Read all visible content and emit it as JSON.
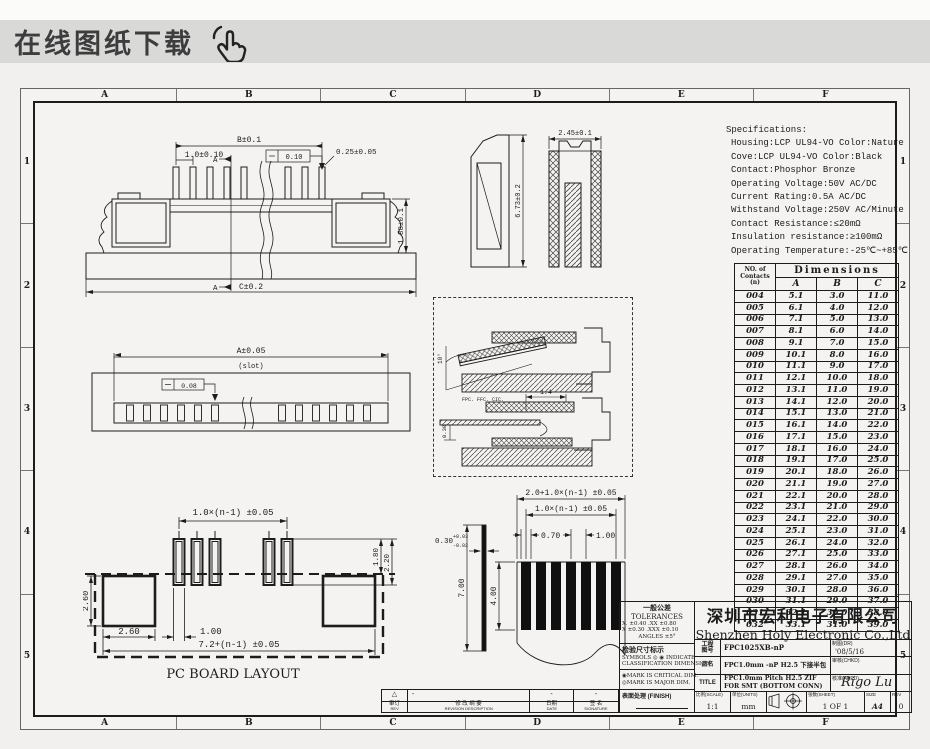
{
  "banner": {
    "title": "在线图纸下载",
    "icon": "hand-pointer-icon"
  },
  "colors": {
    "banner_bg": "#d9d9d8",
    "paper": "#f4f3f1",
    "line": "#1c1c1c"
  },
  "sheet": {
    "zones_h": [
      "A",
      "B",
      "C",
      "D",
      "E",
      "F"
    ],
    "zones_v": [
      "1",
      "2",
      "3",
      "4",
      "5"
    ]
  },
  "specifications": {
    "title": "Specifications:",
    "lines": [
      "Housing:LCP UL94-VO Color:Nature",
      "Cove:LCP UL94-VO Color:Black",
      "Contact:Phosphor Bronze",
      "Operating Voltage:50V AC/DC",
      "Current Rating:0.5A AC/DC",
      "Withstand Voltage:250V AC/Minute",
      "Contact Resistance:≤20mΩ",
      "Insulation resistance:≥100mΩ",
      "Operating Temperature:-25℃~+85℃"
    ]
  },
  "dim_table": {
    "row_header_1": "NO. of",
    "row_header_2": "Contacts",
    "row_header_3": "(n)",
    "col_group": "Dimensions",
    "columns": [
      "A",
      "B",
      "C"
    ],
    "rows": [
      [
        "004",
        "5.1",
        "3.0",
        "11.0"
      ],
      [
        "005",
        "6.1",
        "4.0",
        "12.0"
      ],
      [
        "006",
        "7.1",
        "5.0",
        "13.0"
      ],
      [
        "007",
        "8.1",
        "6.0",
        "14.0"
      ],
      [
        "008",
        "9.1",
        "7.0",
        "15.0"
      ],
      [
        "009",
        "10.1",
        "8.0",
        "16.0"
      ],
      [
        "010",
        "11.1",
        "9.0",
        "17.0"
      ],
      [
        "011",
        "12.1",
        "10.0",
        "18.0"
      ],
      [
        "012",
        "13.1",
        "11.0",
        "19.0"
      ],
      [
        "013",
        "14.1",
        "12.0",
        "20.0"
      ],
      [
        "014",
        "15.1",
        "13.0",
        "21.0"
      ],
      [
        "015",
        "16.1",
        "14.0",
        "22.0"
      ],
      [
        "016",
        "17.1",
        "15.0",
        "23.0"
      ],
      [
        "017",
        "18.1",
        "16.0",
        "24.0"
      ],
      [
        "018",
        "19.1",
        "17.0",
        "25.0"
      ],
      [
        "019",
        "20.1",
        "18.0",
        "26.0"
      ],
      [
        "020",
        "21.1",
        "19.0",
        "27.0"
      ],
      [
        "021",
        "22.1",
        "20.0",
        "28.0"
      ],
      [
        "022",
        "23.1",
        "21.0",
        "29.0"
      ],
      [
        "023",
        "24.1",
        "22.0",
        "30.0"
      ],
      [
        "024",
        "25.1",
        "23.0",
        "31.0"
      ],
      [
        "025",
        "26.1",
        "24.0",
        "32.0"
      ],
      [
        "026",
        "27.1",
        "25.0",
        "33.0"
      ],
      [
        "027",
        "28.1",
        "26.0",
        "34.0"
      ],
      [
        "028",
        "29.1",
        "27.0",
        "35.0"
      ],
      [
        "029",
        "30.1",
        "28.0",
        "36.0"
      ],
      [
        "030",
        "31.1",
        "29.0",
        "37.0"
      ],
      [
        "031",
        "32.1",
        "30.0",
        "38.0"
      ],
      [
        "032",
        "33.1",
        "31.0",
        "39.0"
      ]
    ]
  },
  "views": {
    "front": {
      "dim_b": "B±0.1",
      "pitch": "1.0±0.10",
      "pin_width": "0.25±0.05",
      "flatness": "0.10",
      "height": "1.88±0.1",
      "dim_c": "C±0.2",
      "section_label": "A"
    },
    "side": {
      "height": "6.73±0.2",
      "width": "2.45±0.1"
    },
    "bottom": {
      "dim_a": "A±0.05",
      "slot_note": "(slot)",
      "flatness": "0.08"
    },
    "detail": {
      "angle": "10°",
      "dim_width": "1.4",
      "dim_thick": "0.30",
      "cable_note": "FPC. FFC. CIC."
    },
    "pcb": {
      "pitch": "1.0×(n-1) ±0.05",
      "pad_h1": "1.80",
      "pad_h2": "2.20",
      "height": "2.60",
      "pad_w": "2.60",
      "pad_gap": "1.00",
      "total": "7.2+(n-1) ±0.05",
      "caption": "PC BOARD LAYOUT"
    },
    "fpc": {
      "total": "2.0+1.0×(n-1) ±0.05",
      "pitch": "1.0×(n-1) ±0.05",
      "cond_w": "0.70",
      "cond_pitch": "1.00",
      "thick": "0.30",
      "thick_plus": "+0.03",
      "thick_minus": "-0.02",
      "length": "7.00",
      "exposed": "4.00"
    }
  },
  "title_block": {
    "company_cn": "深圳市宏利电子有限公司",
    "company_en": "Shenzhen Holy Electronic Co.,Ltd",
    "eng_label_1": "工程",
    "eng_label_2": "图号",
    "eng_no": "FPC1025XB-nP",
    "part_label": "品名",
    "part": "FPC1.0mm -nP H2.5 下接半包",
    "title_label": "TITLE",
    "title_line1": "FPC1.0mm Pitch H2.5 ZIF",
    "title_line2": "FOR SMT (BOTTOM CONN)",
    "dr_label": "制图(DR)",
    "dr_value": "'08/5/16",
    "chkd_label": "审核(CHKD)",
    "chkd_value": "",
    "appd_label": "核准(APPD)",
    "appd_value": "Rigo Lu",
    "scale_label": "比例(SCALE)",
    "scale_value": "1:1",
    "units_label": "单位(UNITS)",
    "units_value": "mm",
    "sheet_label": "张数(SHEET)",
    "sheet_value": "1 OF 1",
    "size_label": "SIZE",
    "size_value": "A4",
    "rev_label": "REV",
    "rev_value": "0",
    "tolerances": {
      "title_cn": "一般公差",
      "title_en": "TOLERANCES",
      "line1": "X. ±0.40   .XX ±0.80",
      "line2": "X  ±0.30  .XXX ±0.10",
      "line3": "ANGLES    ±5°",
      "insp_title": "检验尺寸标示",
      "symbols_line1": "SYMBOLS ◎ ◉ INDICATE",
      "symbols_line2": "CLASSIFICATION DIMENSION",
      "critical": "◉MARK IS CRITICAL DIM.",
      "major": "◎MARK IS MAJOR DIM.",
      "finish_label": "表面处理 (FINISH)"
    }
  },
  "revision": {
    "mark": "△",
    "val2": "-",
    "val3": "-",
    "val4": "-",
    "cols": [
      {
        "cn": "审订",
        "en": "REV"
      },
      {
        "cn": "修 改 纲 要",
        "en": "REVISION DESCRIPTION"
      },
      {
        "cn": "日期",
        "en": "DATE"
      },
      {
        "cn": "签 名",
        "en": "SIGNATURE"
      }
    ]
  }
}
